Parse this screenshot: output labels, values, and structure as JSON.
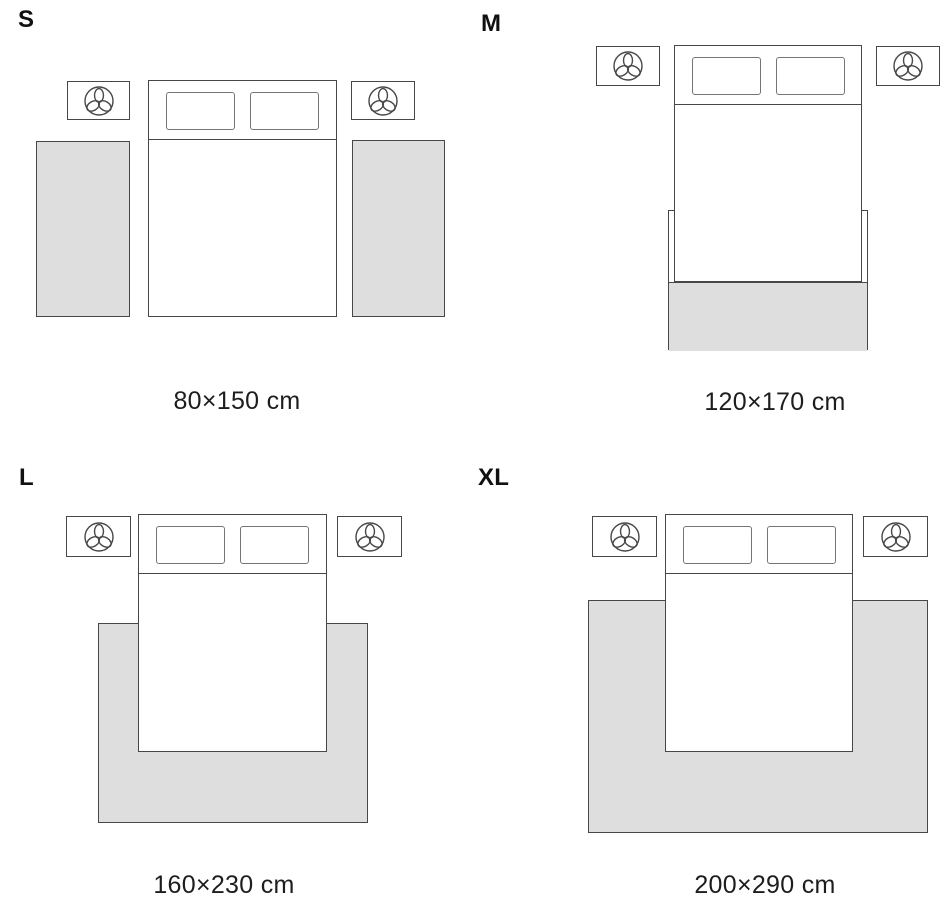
{
  "panels": [
    {
      "size_label": "S",
      "dimensions": "80×150 cm"
    },
    {
      "size_label": "M",
      "dimensions": "120×170 cm"
    },
    {
      "size_label": "L",
      "dimensions": "160×230 cm"
    },
    {
      "size_label": "XL",
      "dimensions": "200×290 cm"
    }
  ],
  "icons": {
    "nightstand": "plant-top-view-icon"
  },
  "colors": {
    "background": "#ffffff",
    "furniture_outline": "#474747",
    "pillow_outline": "#757575",
    "rug_fill": "#dedede",
    "label_text": "#111111",
    "caption_text": "#1d1d1f"
  }
}
